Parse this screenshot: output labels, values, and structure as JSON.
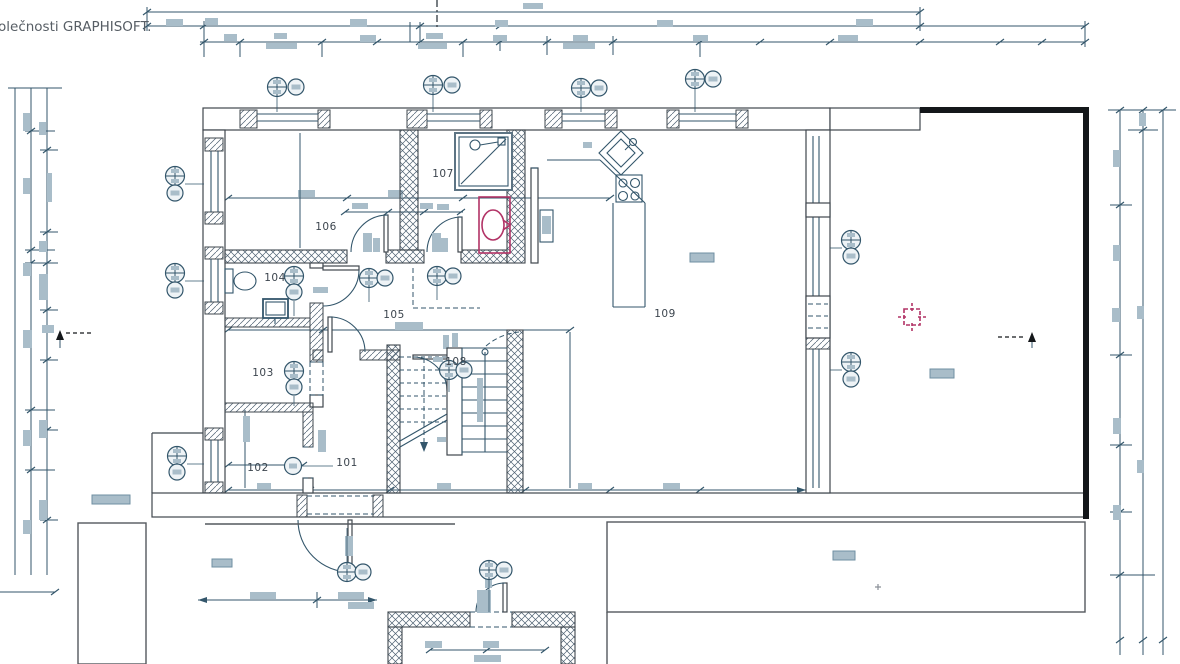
{
  "watermark": "olečnosti GRAPHISOFT.",
  "plan": {
    "type": "architectural-floor-plan",
    "room_labels": [
      {
        "label": "101"
      },
      {
        "label": "102"
      },
      {
        "label": "103"
      },
      {
        "label": "104"
      },
      {
        "label": "105"
      },
      {
        "label": "106"
      },
      {
        "label": "107"
      },
      {
        "label": "108"
      },
      {
        "label": "109"
      }
    ]
  },
  "colors": {
    "line": "#33566b",
    "wall": "#3f474e",
    "outline_gray": "#54595e",
    "placeholder": "#a9bdc9",
    "placeholder_border": "#6f8fa2",
    "red": "#b23366",
    "black": "#14171a",
    "text": "#3c454e",
    "watermark_text": "#575e65"
  }
}
